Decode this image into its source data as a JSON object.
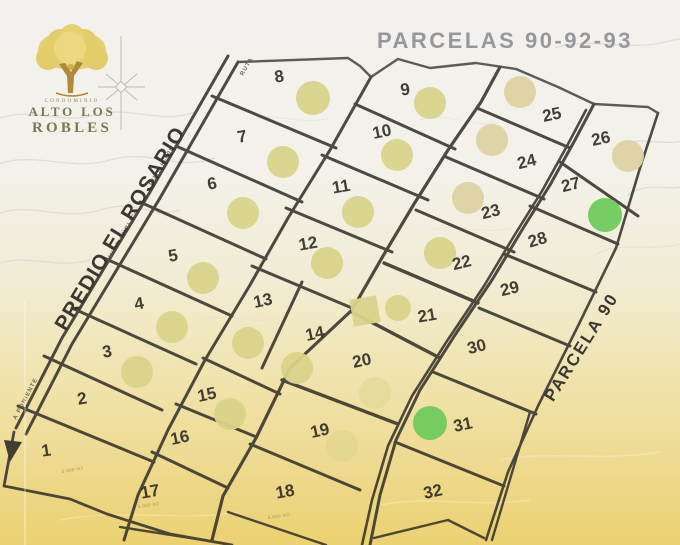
{
  "map": {
    "title": "PARCELAS  90-92-93",
    "left_boundary_label": "PREDIO EL ROSARIO",
    "right_boundary_label": "PARCELA  90",
    "logo": {
      "top": "CONDOMINIO",
      "line1": "ALTO LOS",
      "line2": "ROBLES"
    },
    "colors": {
      "pale": "#d8d38a",
      "tan": "#ddd2a2",
      "green": "#6fca5c",
      "line": "#36332c"
    },
    "road_labels": [
      {
        "text": "CAMINO PÚBLICO",
        "x": 106,
        "y": 268,
        "rot": -60,
        "size": 6
      },
      {
        "text": "RUTA  K-605",
        "x": 152,
        "y": 186,
        "rot": -60,
        "size": 6
      },
      {
        "text": "RUTA",
        "x": 243,
        "y": 76,
        "rot": -60,
        "size": 5
      },
      {
        "text": "A PONIENTE",
        "x": 16,
        "y": 420,
        "rot": -62,
        "size": 5
      }
    ],
    "parcels": [
      {
        "n": "8",
        "x": 280,
        "y": 82,
        "rot": -8
      },
      {
        "n": "9",
        "x": 406,
        "y": 95,
        "rot": -8
      },
      {
        "n": "25",
        "x": 553,
        "y": 120,
        "rot": -12
      },
      {
        "n": "26",
        "x": 602,
        "y": 144,
        "rot": -12
      },
      {
        "n": "7",
        "x": 243,
        "y": 142,
        "rot": -10
      },
      {
        "n": "10",
        "x": 383,
        "y": 137,
        "rot": -12
      },
      {
        "n": "24",
        "x": 528,
        "y": 167,
        "rot": -14
      },
      {
        "n": "27",
        "x": 572,
        "y": 190,
        "rot": -14
      },
      {
        "n": "6",
        "x": 213,
        "y": 189,
        "rot": -10
      },
      {
        "n": "11",
        "x": 342,
        "y": 192,
        "rot": -10
      },
      {
        "n": "23",
        "x": 492,
        "y": 217,
        "rot": -14
      },
      {
        "n": "28",
        "x": 539,
        "y": 245,
        "rot": -16
      },
      {
        "n": "5",
        "x": 174,
        "y": 261,
        "rot": -10
      },
      {
        "n": "12",
        "x": 309,
        "y": 249,
        "rot": -10
      },
      {
        "n": "22",
        "x": 463,
        "y": 268,
        "rot": -14
      },
      {
        "n": "29",
        "x": 511,
        "y": 294,
        "rot": -14
      },
      {
        "n": "4",
        "x": 140,
        "y": 309,
        "rot": -10
      },
      {
        "n": "13",
        "x": 264,
        "y": 306,
        "rot": -12
      },
      {
        "n": "14",
        "x": 316,
        "y": 339,
        "rot": -12
      },
      {
        "n": "21",
        "x": 428,
        "y": 321,
        "rot": -10
      },
      {
        "n": "30",
        "x": 478,
        "y": 352,
        "rot": -14
      },
      {
        "n": "3",
        "x": 108,
        "y": 357,
        "rot": -10
      },
      {
        "n": "20",
        "x": 363,
        "y": 366,
        "rot": -12
      },
      {
        "n": "2",
        "x": 83,
        "y": 404,
        "rot": -10
      },
      {
        "n": "15",
        "x": 208,
        "y": 400,
        "rot": -12
      },
      {
        "n": "19",
        "x": 321,
        "y": 436,
        "rot": -12
      },
      {
        "n": "31",
        "x": 464,
        "y": 430,
        "rot": -12
      },
      {
        "n": "1",
        "x": 47,
        "y": 456,
        "rot": -8
      },
      {
        "n": "16",
        "x": 181,
        "y": 443,
        "rot": -12
      },
      {
        "n": "17",
        "x": 151,
        "y": 497,
        "rot": -10
      },
      {
        "n": "18",
        "x": 286,
        "y": 497,
        "rot": -10
      },
      {
        "n": "32",
        "x": 434,
        "y": 497,
        "rot": -12
      }
    ],
    "markers": [
      {
        "type": "circle",
        "x": 313,
        "y": 98,
        "r": 17,
        "c": "pale"
      },
      {
        "type": "circle",
        "x": 430,
        "y": 103,
        "r": 16,
        "c": "pale"
      },
      {
        "type": "circle",
        "x": 520,
        "y": 92,
        "r": 16,
        "c": "tan"
      },
      {
        "type": "circle",
        "x": 283,
        "y": 162,
        "r": 16,
        "c": "pale"
      },
      {
        "type": "circle",
        "x": 397,
        "y": 155,
        "r": 16,
        "c": "pale"
      },
      {
        "type": "circle",
        "x": 492,
        "y": 140,
        "r": 16,
        "c": "tan"
      },
      {
        "type": "circle",
        "x": 628,
        "y": 156,
        "r": 16,
        "c": "tan"
      },
      {
        "type": "circle",
        "x": 243,
        "y": 213,
        "r": 16,
        "c": "pale"
      },
      {
        "type": "circle",
        "x": 358,
        "y": 212,
        "r": 16,
        "c": "pale"
      },
      {
        "type": "circle",
        "x": 468,
        "y": 198,
        "r": 16,
        "c": "tan"
      },
      {
        "type": "circle",
        "x": 605,
        "y": 215,
        "r": 17,
        "c": "green"
      },
      {
        "type": "circle",
        "x": 203,
        "y": 278,
        "r": 16,
        "c": "pale"
      },
      {
        "type": "circle",
        "x": 327,
        "y": 263,
        "r": 16,
        "c": "pale"
      },
      {
        "type": "circle",
        "x": 440,
        "y": 253,
        "r": 16,
        "c": "pale"
      },
      {
        "type": "circle",
        "x": 172,
        "y": 327,
        "r": 16,
        "c": "pale"
      },
      {
        "type": "circle",
        "x": 248,
        "y": 343,
        "r": 16,
        "c": "pale"
      },
      {
        "type": "square",
        "x": 365,
        "y": 311,
        "w": 27,
        "rot": -10,
        "c": "pale"
      },
      {
        "type": "circle",
        "x": 398,
        "y": 308,
        "r": 13,
        "c": "pale"
      },
      {
        "type": "circle",
        "x": 297,
        "y": 368,
        "r": 16,
        "c": "pale"
      },
      {
        "type": "circle",
        "x": 137,
        "y": 372,
        "r": 16,
        "c": "pale"
      },
      {
        "type": "circle",
        "x": 230,
        "y": 414,
        "r": 16,
        "c": "pale"
      },
      {
        "type": "circle",
        "x": 375,
        "y": 393,
        "r": 16,
        "c": "pale",
        "o": 0.4
      },
      {
        "type": "circle",
        "x": 342,
        "y": 446,
        "r": 16,
        "c": "pale",
        "o": 0.45
      },
      {
        "type": "circle",
        "x": 430,
        "y": 423,
        "r": 17,
        "c": "green"
      }
    ],
    "area_labels": [
      {
        "text": "5.000 m2",
        "x": 62,
        "y": 473,
        "rot": -10
      },
      {
        "text": "5.000 m2",
        "x": 138,
        "y": 508,
        "rot": -8
      },
      {
        "text": "5.000 m2",
        "x": 268,
        "y": 519,
        "rot": -8
      }
    ]
  }
}
